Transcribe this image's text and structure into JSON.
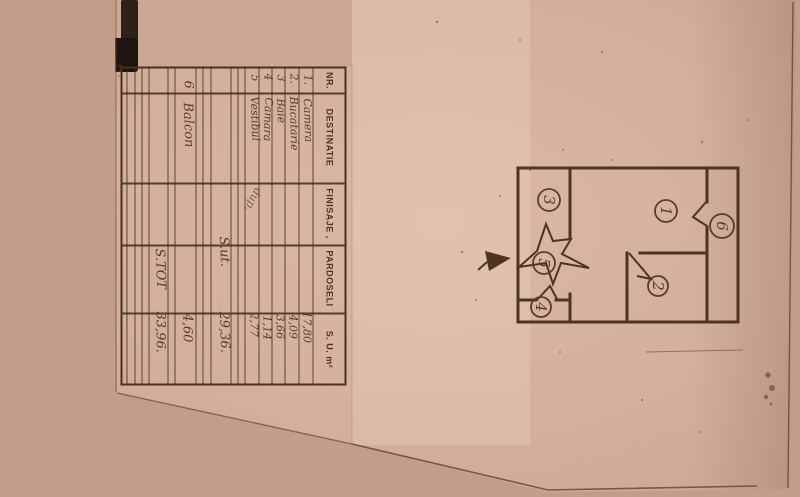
{
  "table": {
    "headers": [
      "NR.",
      "DESTINATIE",
      "FINISAJE ,",
      "PARDOSELI",
      "S. U. m²"
    ],
    "rows": [
      {
        "nr": "1.",
        "destinatie": "Camera",
        "su": "17,80"
      },
      {
        "nr": "2.",
        "destinatie": "Bucatarie",
        "su": "4,09"
      },
      {
        "nr": "3",
        "destinatie": "Baie",
        "su": "3,66"
      },
      {
        "nr": "4",
        "destinatie": "Camara",
        "su": "1,14"
      },
      {
        "nr": "5",
        "destinatie": "Vestibul",
        "su": "2,77"
      }
    ],
    "finisaje_note": "dup.",
    "subtotal": {
      "label": "S.ut.",
      "value": "29,36."
    },
    "balcony_row": {
      "nr": "6",
      "destinatie": "Balcon",
      "su": "4,60"
    },
    "total": {
      "label": "S.TOT",
      "value": "33,96."
    }
  },
  "floor_plan": {
    "rooms": [
      "1",
      "2",
      "3",
      "4",
      "5",
      "6"
    ]
  },
  "colors": {
    "paper": "#d3b09c",
    "background": "#c49c8b",
    "ink": "#4f3424",
    "handwriting": "#5a3c2b",
    "corner_mark": "#1e1510"
  }
}
